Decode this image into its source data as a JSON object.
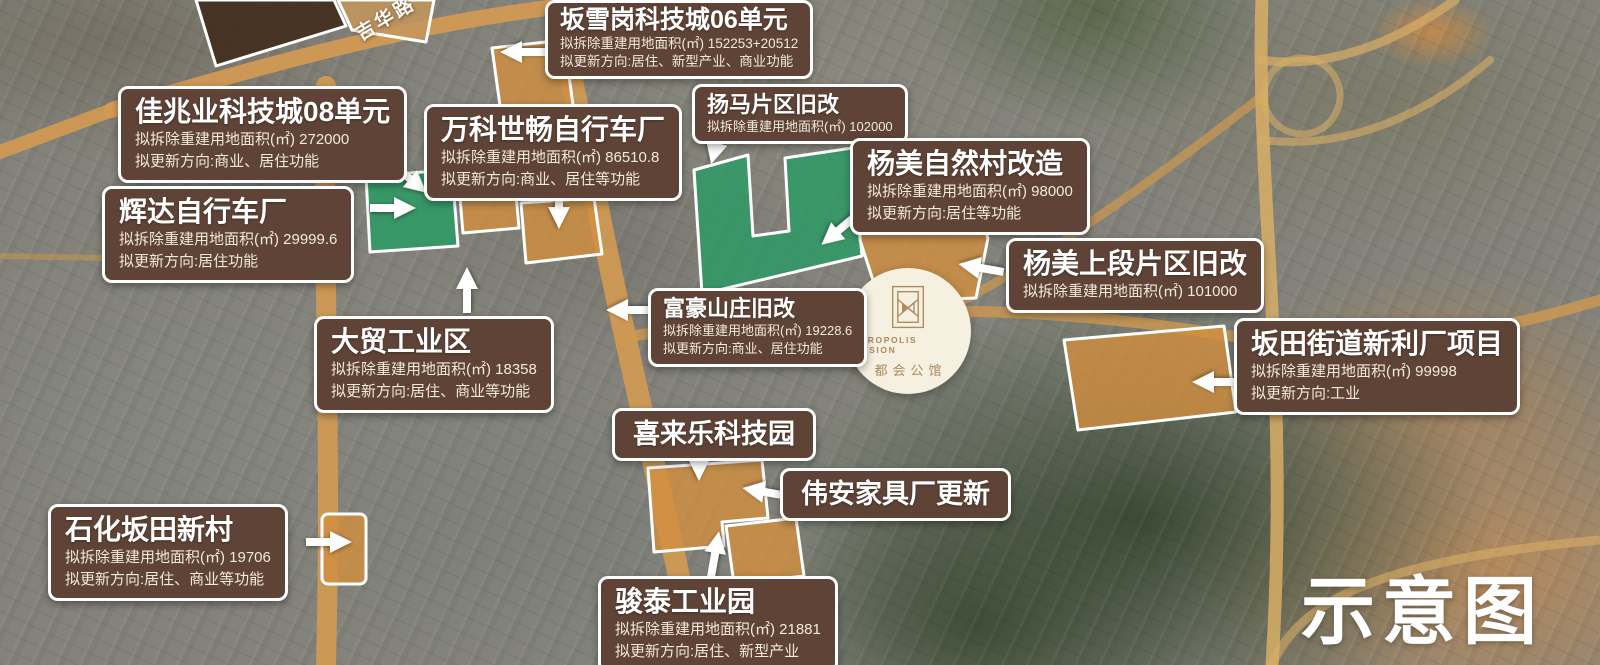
{
  "map": {
    "road_label": "吉华路",
    "watermark": "示意图"
  },
  "logo": {
    "en": "METROPOLIS MANSION",
    "cn": "都会公馆"
  },
  "colors": {
    "callout_bg": "#5e4336",
    "parcel_orange": "#d28f3f",
    "parcel_green": "#2b9b64",
    "parcel_dark_brown": "#402a1a",
    "road": "#d49a52",
    "logo_gold": "#ab8a5c"
  },
  "callouts": [
    {
      "title": "坂雪岗科技城06单元",
      "area": "拟拆除重建用地面积(㎡) 152253+20512",
      "direction": "拟更新方向:居住、新型产业、商业功能"
    },
    {
      "title": "佳兆业科技城08单元",
      "area": "拟拆除重建用地面积(㎡) 272000",
      "direction": "拟更新方向:商业、居住功能"
    },
    {
      "title": "万科世畅自行车厂",
      "area": "拟拆除重建用地面积(㎡) 86510.8",
      "direction": "拟更新方向:商业、居住等功能"
    },
    {
      "title": "扬马片区旧改",
      "area": "拟拆除重建用地面积(㎡) 102000"
    },
    {
      "title": "杨美自然村改造",
      "area": "拟拆除重建用地面积(㎡) 98000",
      "direction": "拟更新方向:居住等功能"
    },
    {
      "title": "辉达自行车厂",
      "area": "拟拆除重建用地面积(㎡) 29999.6",
      "direction": "拟更新方向:居住功能"
    },
    {
      "title": "杨美上段片区旧改",
      "area": "拟拆除重建用地面积(㎡) 101000"
    },
    {
      "title": "富豪山庄旧改",
      "area": "拟拆除重建用地面积(㎡) 19228.6",
      "direction": "拟更新方向:商业、居住功能"
    },
    {
      "title": "大贸工业区",
      "area": "拟拆除重建用地面积(㎡) 18358",
      "direction": "拟更新方向:居住、商业等功能"
    },
    {
      "title": "坂田街道新利厂项目",
      "area": "拟拆除重建用地面积(㎡) 99998",
      "direction": "拟更新方向:工业"
    },
    {
      "title": "喜来乐科技园"
    },
    {
      "title": "伟安家具厂更新"
    },
    {
      "title": "石化坂田新村",
      "area": "拟拆除重建用地面积(㎡) 19706",
      "direction": "拟更新方向:居住、商业等功能"
    },
    {
      "title": "骏泰工业园",
      "area": "拟拆除重建用地面积(㎡) 21881",
      "direction": "拟更新方向:居住、新型产业"
    }
  ]
}
